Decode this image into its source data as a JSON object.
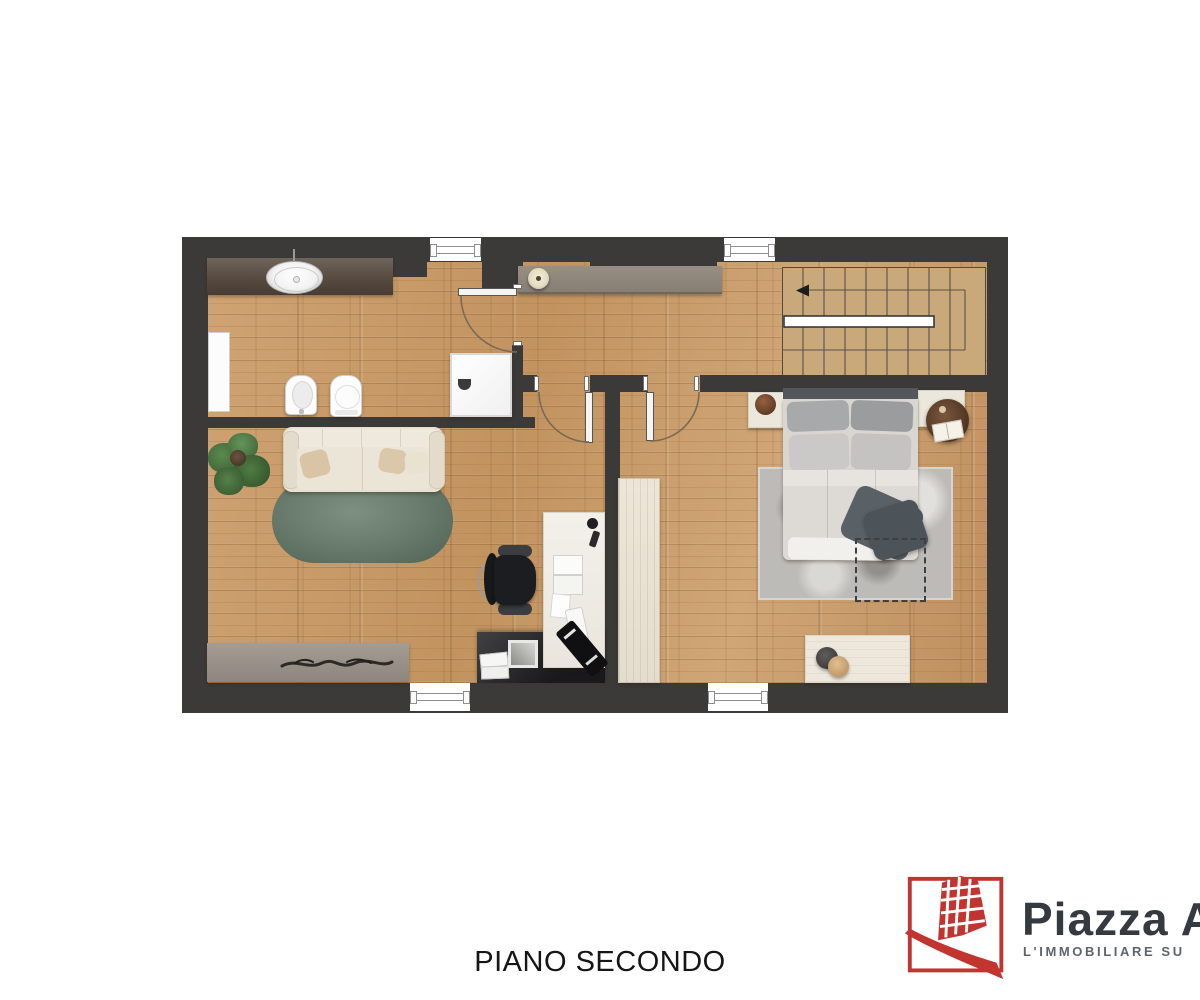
{
  "title": "PIANO SECONDO",
  "logo": {
    "brand": "Piazza Af",
    "tagline": "L'IMMOBILIARE SU"
  },
  "colors": {
    "wall": "#3b3a38",
    "floor_wood": "#c79c6d",
    "stairs": "#c9a87a",
    "living_rug_green": "#66796a",
    "bedroom_rug_gray": "#bcbbb7",
    "console_gray": "#8e867c",
    "logo_red": "#c2342f",
    "brand_text": "#343a40",
    "tagline_text": "#5f6468",
    "title_text": "#151515"
  }
}
